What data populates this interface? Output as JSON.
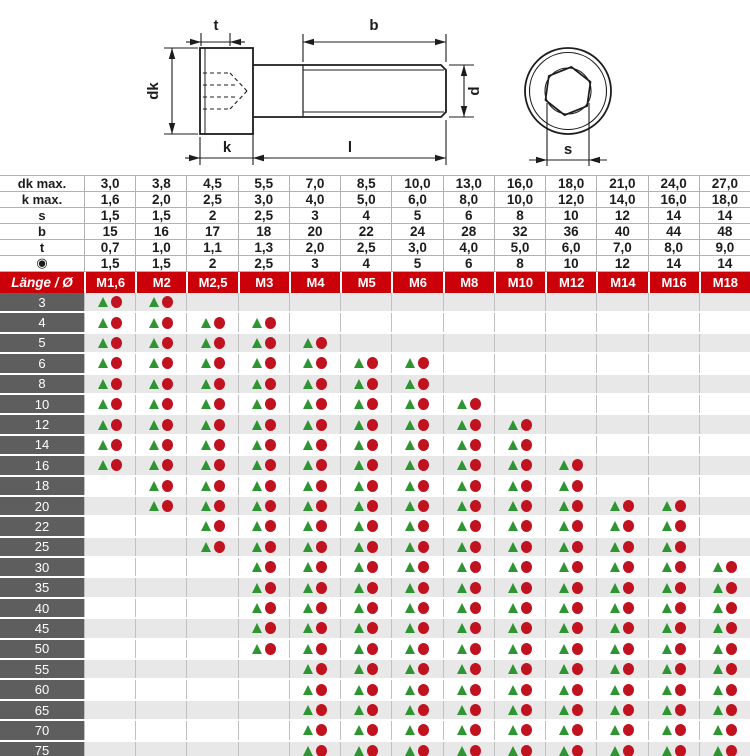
{
  "colors": {
    "header_red": "#cb0009",
    "circle_red": "#c1121f",
    "triangle_green": "#2e9532",
    "row_label_gray": "#5e5e5e",
    "alt_row_gray": "#e8e8e8",
    "gridline": "#c0c0c0",
    "line_ink": "#1c1c1c"
  },
  "drawing": {
    "labels": {
      "t": "t",
      "b": "b",
      "dk": "dk",
      "k": "k",
      "l": "l",
      "d": "d",
      "s": "s"
    }
  },
  "spec_table": {
    "rows": [
      {
        "label": "dk max.",
        "values": [
          "3,0",
          "3,8",
          "4,5",
          "5,5",
          "7,0",
          "8,5",
          "10,0",
          "13,0",
          "16,0",
          "18,0",
          "21,0",
          "24,0",
          "27,0"
        ]
      },
      {
        "label": "k max.",
        "values": [
          "1,6",
          "2,0",
          "2,5",
          "3,0",
          "4,0",
          "5,0",
          "6,0",
          "8,0",
          "10,0",
          "12,0",
          "14,0",
          "16,0",
          "18,0"
        ]
      },
      {
        "label": "s",
        "values": [
          "1,5",
          "1,5",
          "2",
          "2,5",
          "3",
          "4",
          "5",
          "6",
          "8",
          "10",
          "12",
          "14",
          "14"
        ]
      },
      {
        "label": "b",
        "values": [
          "15",
          "16",
          "17",
          "18",
          "20",
          "22",
          "24",
          "28",
          "32",
          "36",
          "40",
          "44",
          "48"
        ]
      },
      {
        "label": "t",
        "values": [
          "0,7",
          "1,0",
          "1,1",
          "1,3",
          "2,0",
          "2,5",
          "3,0",
          "4,0",
          "5,0",
          "6,0",
          "7,0",
          "8,0",
          "9,0"
        ]
      },
      {
        "label": "◉",
        "values": [
          "1,5",
          "1,5",
          "2",
          "2,5",
          "3",
          "4",
          "5",
          "6",
          "8",
          "10",
          "12",
          "14",
          "14"
        ]
      }
    ]
  },
  "matrix": {
    "header_label": "Länge / Ø",
    "sizes": [
      "M1,6",
      "M2",
      "M2,5",
      "M3",
      "M4",
      "M5",
      "M6",
      "M8",
      "M10",
      "M12",
      "M14",
      "M16",
      "M18"
    ],
    "symbols": {
      "triangle": "green-triangle",
      "circle": "red-circle"
    },
    "rows": [
      {
        "length": "3",
        "available": [
          1,
          1,
          0,
          0,
          0,
          0,
          0,
          0,
          0,
          0,
          0,
          0,
          0
        ]
      },
      {
        "length": "4",
        "available": [
          1,
          1,
          1,
          1,
          0,
          0,
          0,
          0,
          0,
          0,
          0,
          0,
          0
        ]
      },
      {
        "length": "5",
        "available": [
          1,
          1,
          1,
          1,
          1,
          0,
          0,
          0,
          0,
          0,
          0,
          0,
          0
        ]
      },
      {
        "length": "6",
        "available": [
          1,
          1,
          1,
          1,
          1,
          1,
          1,
          0,
          0,
          0,
          0,
          0,
          0
        ]
      },
      {
        "length": "8",
        "available": [
          1,
          1,
          1,
          1,
          1,
          1,
          1,
          0,
          0,
          0,
          0,
          0,
          0
        ]
      },
      {
        "length": "10",
        "available": [
          1,
          1,
          1,
          1,
          1,
          1,
          1,
          1,
          0,
          0,
          0,
          0,
          0
        ]
      },
      {
        "length": "12",
        "available": [
          1,
          1,
          1,
          1,
          1,
          1,
          1,
          1,
          1,
          0,
          0,
          0,
          0
        ]
      },
      {
        "length": "14",
        "available": [
          1,
          1,
          1,
          1,
          1,
          1,
          1,
          1,
          1,
          0,
          0,
          0,
          0
        ]
      },
      {
        "length": "16",
        "available": [
          1,
          1,
          1,
          1,
          1,
          1,
          1,
          1,
          1,
          1,
          0,
          0,
          0
        ]
      },
      {
        "length": "18",
        "available": [
          0,
          1,
          1,
          1,
          1,
          1,
          1,
          1,
          1,
          1,
          0,
          0,
          0
        ]
      },
      {
        "length": "20",
        "available": [
          0,
          1,
          1,
          1,
          1,
          1,
          1,
          1,
          1,
          1,
          1,
          1,
          0
        ]
      },
      {
        "length": "22",
        "available": [
          0,
          0,
          1,
          1,
          1,
          1,
          1,
          1,
          1,
          1,
          1,
          1,
          0
        ]
      },
      {
        "length": "25",
        "available": [
          0,
          0,
          1,
          1,
          1,
          1,
          1,
          1,
          1,
          1,
          1,
          1,
          0
        ]
      },
      {
        "length": "30",
        "available": [
          0,
          0,
          0,
          1,
          1,
          1,
          1,
          1,
          1,
          1,
          1,
          1,
          1
        ]
      },
      {
        "length": "35",
        "available": [
          0,
          0,
          0,
          1,
          1,
          1,
          1,
          1,
          1,
          1,
          1,
          1,
          1
        ]
      },
      {
        "length": "40",
        "available": [
          0,
          0,
          0,
          1,
          1,
          1,
          1,
          1,
          1,
          1,
          1,
          1,
          1
        ]
      },
      {
        "length": "45",
        "available": [
          0,
          0,
          0,
          1,
          1,
          1,
          1,
          1,
          1,
          1,
          1,
          1,
          1
        ]
      },
      {
        "length": "50",
        "available": [
          0,
          0,
          0,
          1,
          1,
          1,
          1,
          1,
          1,
          1,
          1,
          1,
          1
        ]
      },
      {
        "length": "55",
        "available": [
          0,
          0,
          0,
          0,
          1,
          1,
          1,
          1,
          1,
          1,
          1,
          1,
          1
        ]
      },
      {
        "length": "60",
        "available": [
          0,
          0,
          0,
          0,
          1,
          1,
          1,
          1,
          1,
          1,
          1,
          1,
          1
        ]
      },
      {
        "length": "65",
        "available": [
          0,
          0,
          0,
          0,
          1,
          1,
          1,
          1,
          1,
          1,
          1,
          1,
          1
        ]
      },
      {
        "length": "70",
        "available": [
          0,
          0,
          0,
          0,
          1,
          1,
          1,
          1,
          1,
          1,
          1,
          1,
          1
        ]
      },
      {
        "length": "75",
        "available": [
          0,
          0,
          0,
          0,
          1,
          1,
          1,
          1,
          1,
          1,
          1,
          1,
          1
        ]
      }
    ]
  }
}
